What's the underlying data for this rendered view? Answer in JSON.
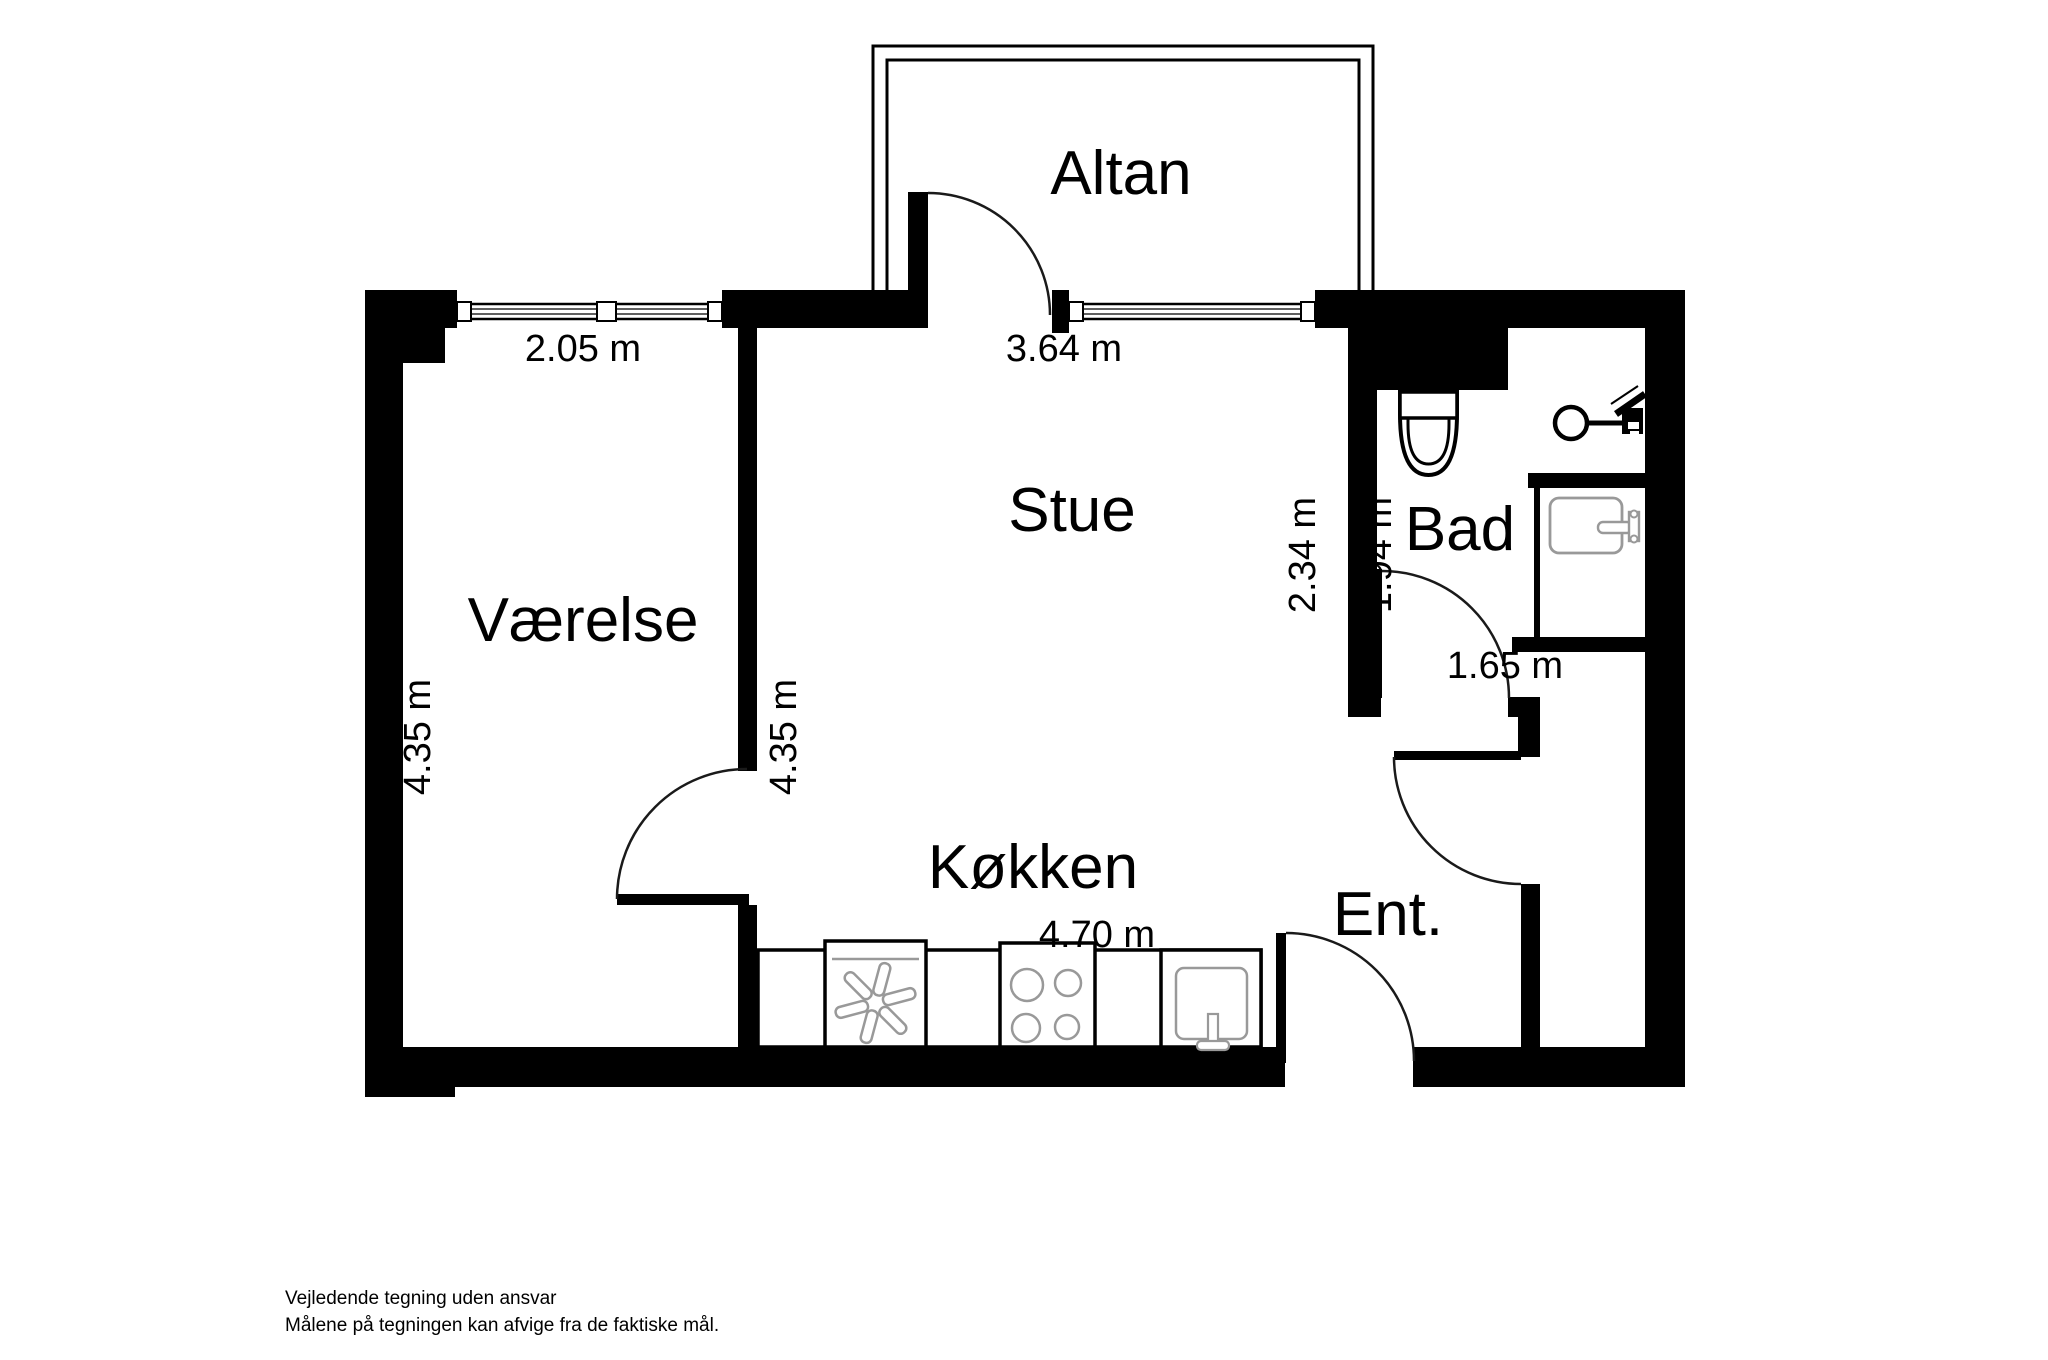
{
  "title": "Apartment floor plan",
  "colors": {
    "background": "#ffffff",
    "wall": "#000000",
    "door_arc": "#1a1a1a",
    "fixture_outline": "#999999",
    "appliance_outline": "#000000"
  },
  "rooms": {
    "altan": "Altan",
    "vaerelse": "Værelse",
    "stue": "Stue",
    "koekken": "Køkken",
    "bad": "Bad",
    "ent": "Ent."
  },
  "measurements": {
    "vaerelse_width": "2.05 m",
    "stue_width": "3.64 m",
    "vaerelse_depth": "4.35 m",
    "stue_depth": "4.35 m",
    "stue_right_depth": "2.34 m",
    "bad_depth": "1.94 m",
    "bad_width": "1.65 m",
    "koekken_width": "4.70 m"
  },
  "icons": {
    "toilet": "toilet-icon",
    "shower": "shower-icon",
    "bath_sink": "washbasin-icon",
    "extractor_fan": "extractor-fan-icon",
    "cooktop": "cooktop-icon",
    "kitchen_sink": "kitchen-sink-icon",
    "windows": "window-glyph",
    "doors": "door-swing-glyph"
  },
  "footer": {
    "line1": "Vejledende tegning uden ansvar",
    "line2": "Målene på tegningen kan afvige fra de faktiske mål."
  }
}
